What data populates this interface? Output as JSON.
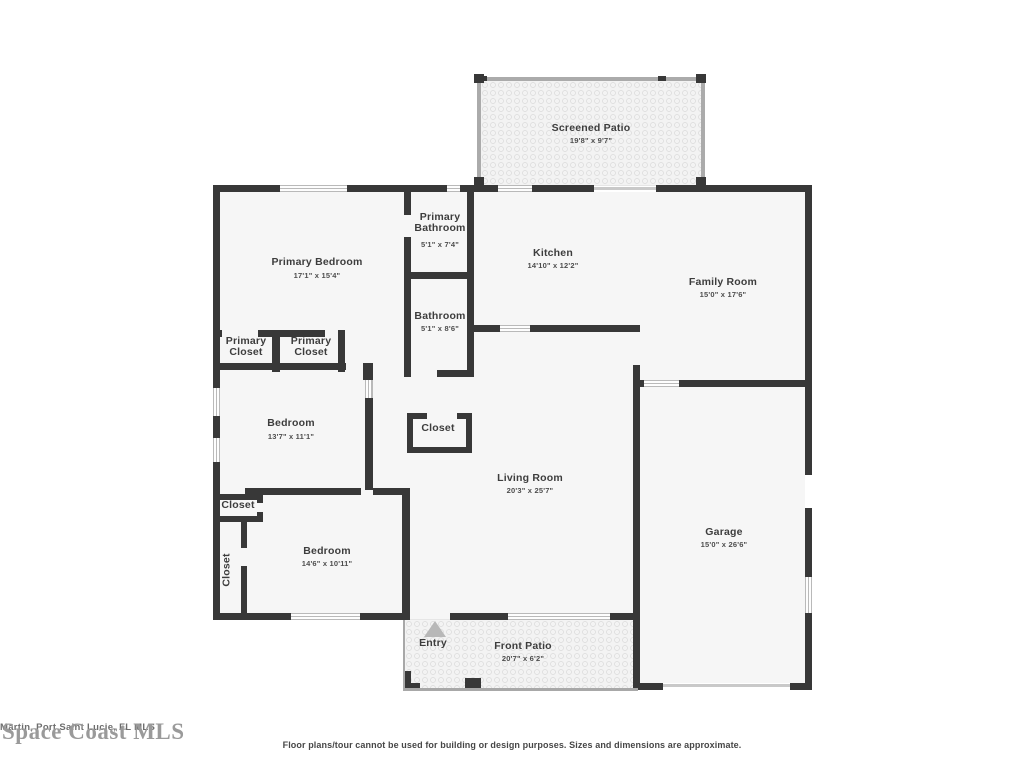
{
  "colors": {
    "wall": "#383838",
    "floor": "#f6f6f6",
    "window": "#d6d6d6",
    "label_text": "#3d3d3d",
    "watermark": "#9a9a9a",
    "entry_arrow": "#b8b8b8"
  },
  "rooms": [
    {
      "name": "Screened Patio",
      "dims": "19'8\" x 9'7\""
    },
    {
      "name": "Primary Bedroom",
      "dims": "17'1\" x 15'4\""
    },
    {
      "name": "Primary Bathroom",
      "dims": "5'1\" x 7'4\""
    },
    {
      "name": "Kitchen",
      "dims": "14'10\" x 12'2\""
    },
    {
      "name": "Family Room",
      "dims": "15'0\" x 17'6\""
    },
    {
      "name": "Bathroom",
      "dims": "5'1\" x 8'6\""
    },
    {
      "name": "Primary Closet",
      "dims": ""
    },
    {
      "name": "Primary Closet",
      "dims": ""
    },
    {
      "name": "Bedroom",
      "dims": "13'7\" x 11'1\""
    },
    {
      "name": "Closet",
      "dims": ""
    },
    {
      "name": "Living Room",
      "dims": "20'3\" x 25'7\""
    },
    {
      "name": "Closet",
      "dims": ""
    },
    {
      "name": "Closet",
      "dims": ""
    },
    {
      "name": "Bedroom",
      "dims": "14'6\" x 10'11\""
    },
    {
      "name": "Garage",
      "dims": "15'0\" x 26'6\""
    },
    {
      "name": "Entry",
      "dims": ""
    },
    {
      "name": "Front Patio",
      "dims": "20'7\" x 6'2\""
    }
  ],
  "watermarks": {
    "large": "Space Coast MLS",
    "small": "Martin, Port Saint Lucie, FL MLS"
  },
  "footer": {
    "disclaimer": "Floor plans/tour cannot be used for building or design purposes. Sizes and dimensions are approximate."
  }
}
